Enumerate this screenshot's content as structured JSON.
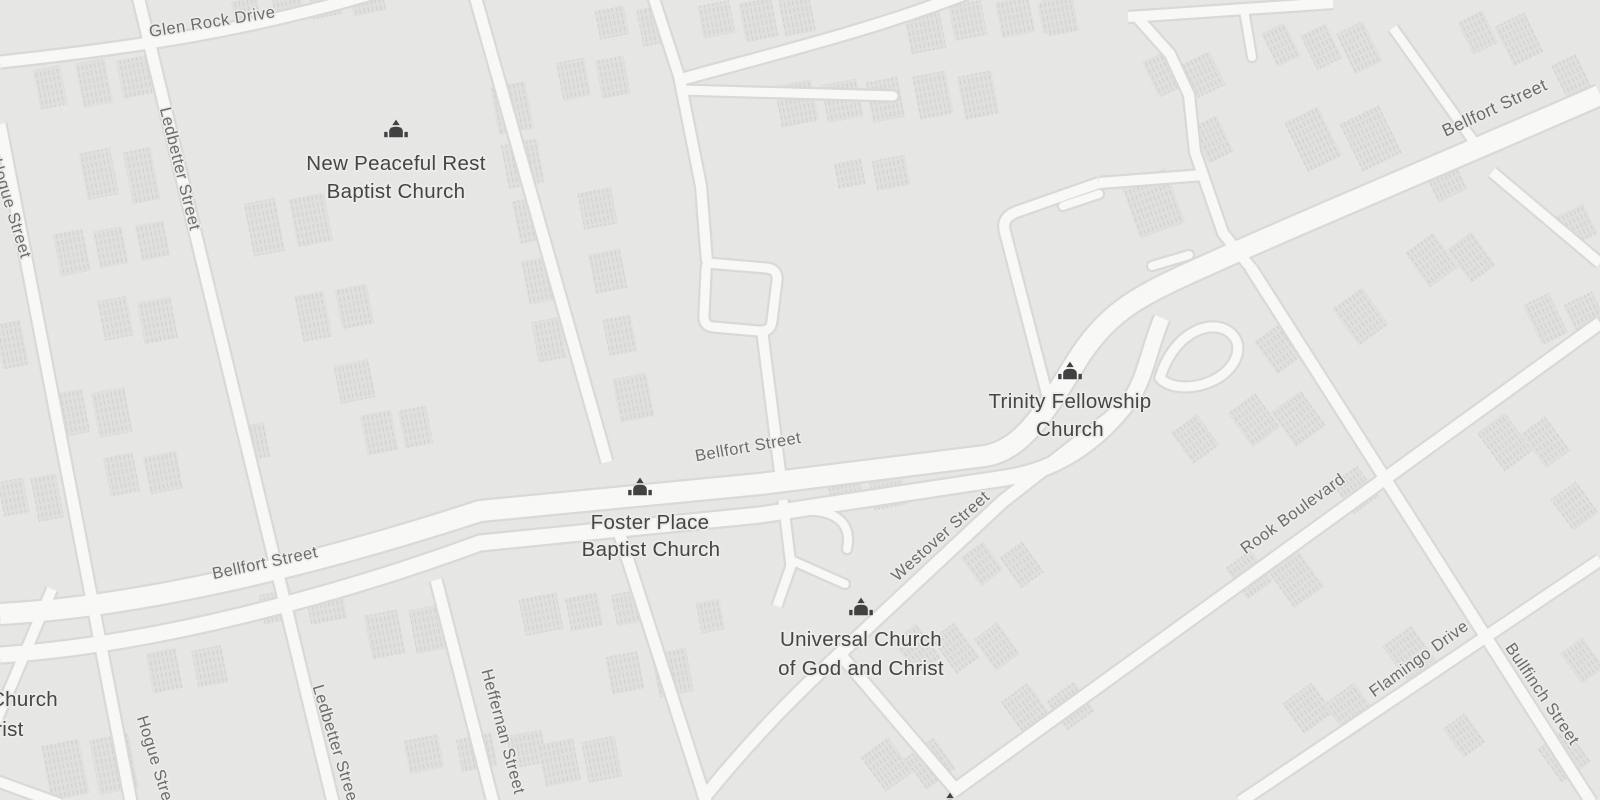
{
  "map": {
    "kind": "grayscale-street-map",
    "street_labels": [
      {
        "id": "glen-rock-drive",
        "text": "Glen Rock Drive"
      },
      {
        "id": "hogue-street-top",
        "text": "Hogue Street"
      },
      {
        "id": "ledbetter-street-top",
        "text": "Ledbetter Street"
      },
      {
        "id": "bellfort-street-west",
        "text": "Bellfort Street"
      },
      {
        "id": "bellfort-street-mid",
        "text": "Bellfort Street"
      },
      {
        "id": "bellfort-street-east",
        "text": "Bellfort Street"
      },
      {
        "id": "westover-street",
        "text": "Westover Street"
      },
      {
        "id": "rook-boulevard",
        "text": "Rook Boulevard"
      },
      {
        "id": "flamingo-drive",
        "text": "Flamingo Drive"
      },
      {
        "id": "bullfinch-street",
        "text": "Bullfinch Street"
      },
      {
        "id": "hogue-street-bottom",
        "text": "Hogue Street"
      },
      {
        "id": "ledbetter-street-bottom",
        "text": "Ledbetter Street"
      },
      {
        "id": "heffernan-street",
        "text": "Heffernan Street"
      }
    ],
    "pois": [
      {
        "id": "new-peaceful-rest-baptist-church",
        "icon": "church-icon",
        "lines": [
          "New Peaceful Rest",
          "Baptist Church"
        ]
      },
      {
        "id": "foster-place-baptist-church",
        "icon": "church-icon",
        "lines": [
          "Foster Place",
          "Baptist Church"
        ]
      },
      {
        "id": "trinity-fellowship-church",
        "icon": "church-icon",
        "lines": [
          "Trinity Fellowship",
          "Church"
        ]
      },
      {
        "id": "universal-church-of-god-and-christ",
        "icon": "church-icon",
        "lines": [
          "Universal Church",
          "of God and Christ"
        ]
      },
      {
        "id": "partial-church-west",
        "icon": "church-icon",
        "lines": [
          "Church",
          "Christ"
        ]
      },
      {
        "id": "partial-church-bottom",
        "icon": "church-icon",
        "lines": [
          "",
          ""
        ]
      }
    ],
    "colors": {
      "background": "#e8e8e6",
      "road_fill": "#fafaf9",
      "road_casing": "#dadbd8",
      "building_fill": "#e1e1e0",
      "building_hatch": "#d1d1d0",
      "street_label": "#6a6a6a",
      "poi_label": "#424242",
      "poi_icon": "#3e3e3e",
      "label_halo": "#eeeeec"
    }
  }
}
